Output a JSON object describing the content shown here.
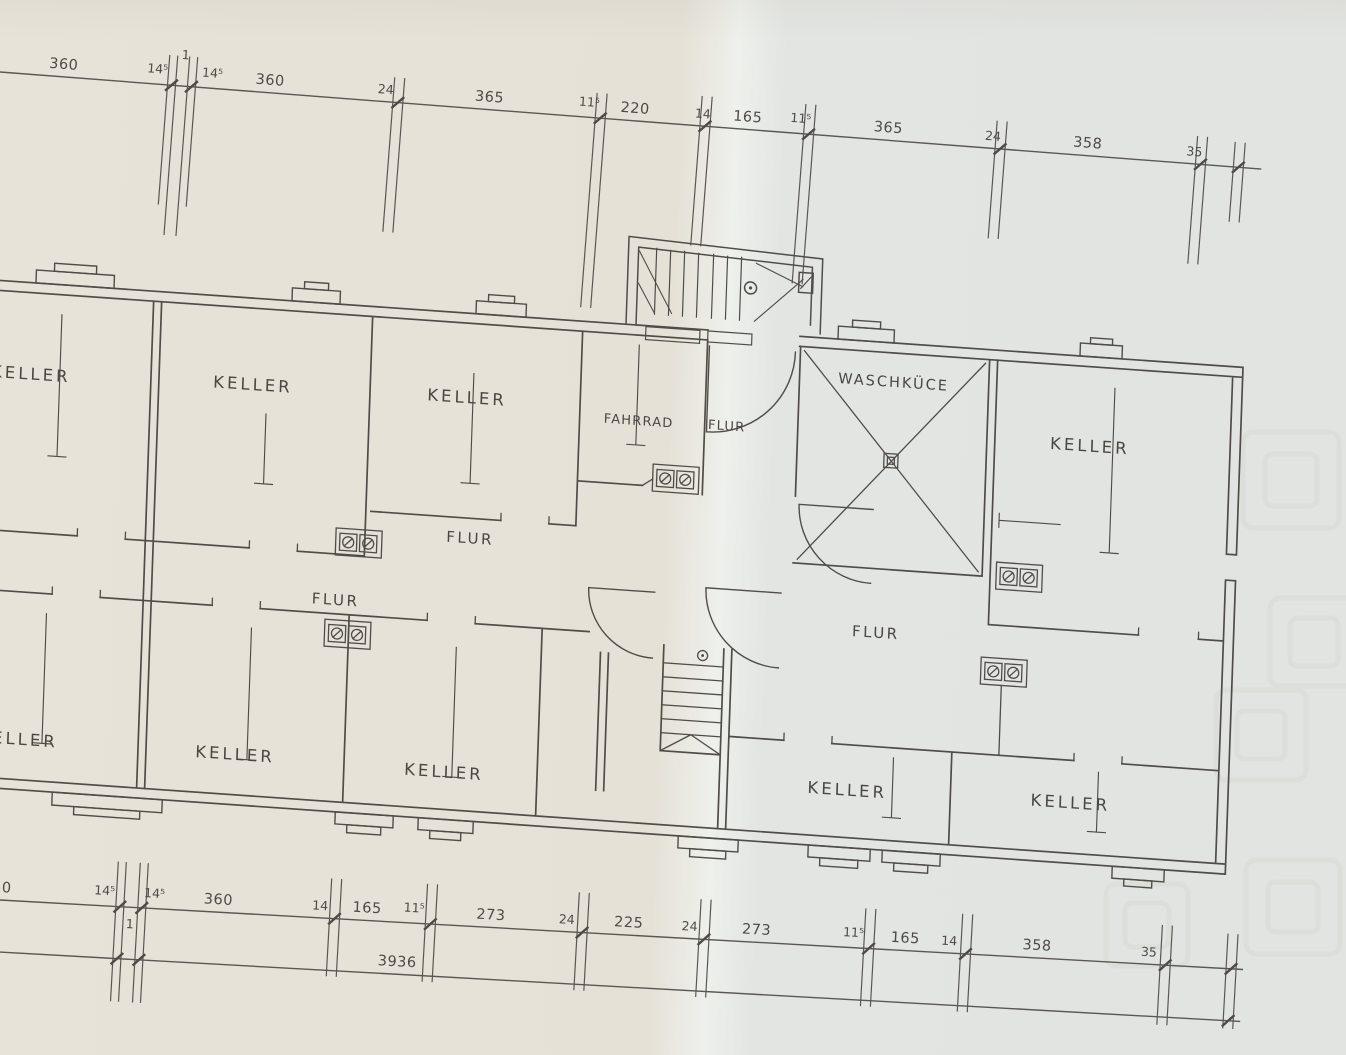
{
  "document": {
    "type": "scanned basement floor plan",
    "paper_left_tone": "#e6e2d8",
    "paper_right_tone": "#e2e4e1",
    "line_color": "#504d48"
  },
  "rooms": {
    "keller_top_far_left": "KELLER",
    "keller_top_left": "KELLER",
    "keller_top_mid": "KELLER",
    "fahrrad": "FAHRRAD",
    "flur_entry": "FLUR",
    "waschkueche": "WASCHKÜCE",
    "keller_top_right": "KELLER",
    "flur_center": "FLUR",
    "flur_left": "FLUR",
    "flur_right": "FLUR",
    "keller_bottom_far_left": "KELLER",
    "keller_bottom_left": "KELLER",
    "keller_bottom_mid": "KELLER",
    "keller_bottom_right": "KELLER",
    "keller_bottom_far_right": "KELLER"
  },
  "dimensions": {
    "top": [
      "360",
      "14⁵",
      "1",
      "14⁵",
      "360",
      "24",
      "365",
      "11⁵",
      "220",
      "14",
      "165",
      "11⁵",
      "365",
      "24",
      "358",
      "35"
    ],
    "bottom": [
      "0",
      "14⁵",
      "1",
      "14⁵",
      "360",
      "14",
      "165",
      "11⁵",
      "273",
      "24",
      "225",
      "24",
      "273",
      "11⁵",
      "165",
      "14",
      "358",
      "35"
    ],
    "total": "3936"
  }
}
